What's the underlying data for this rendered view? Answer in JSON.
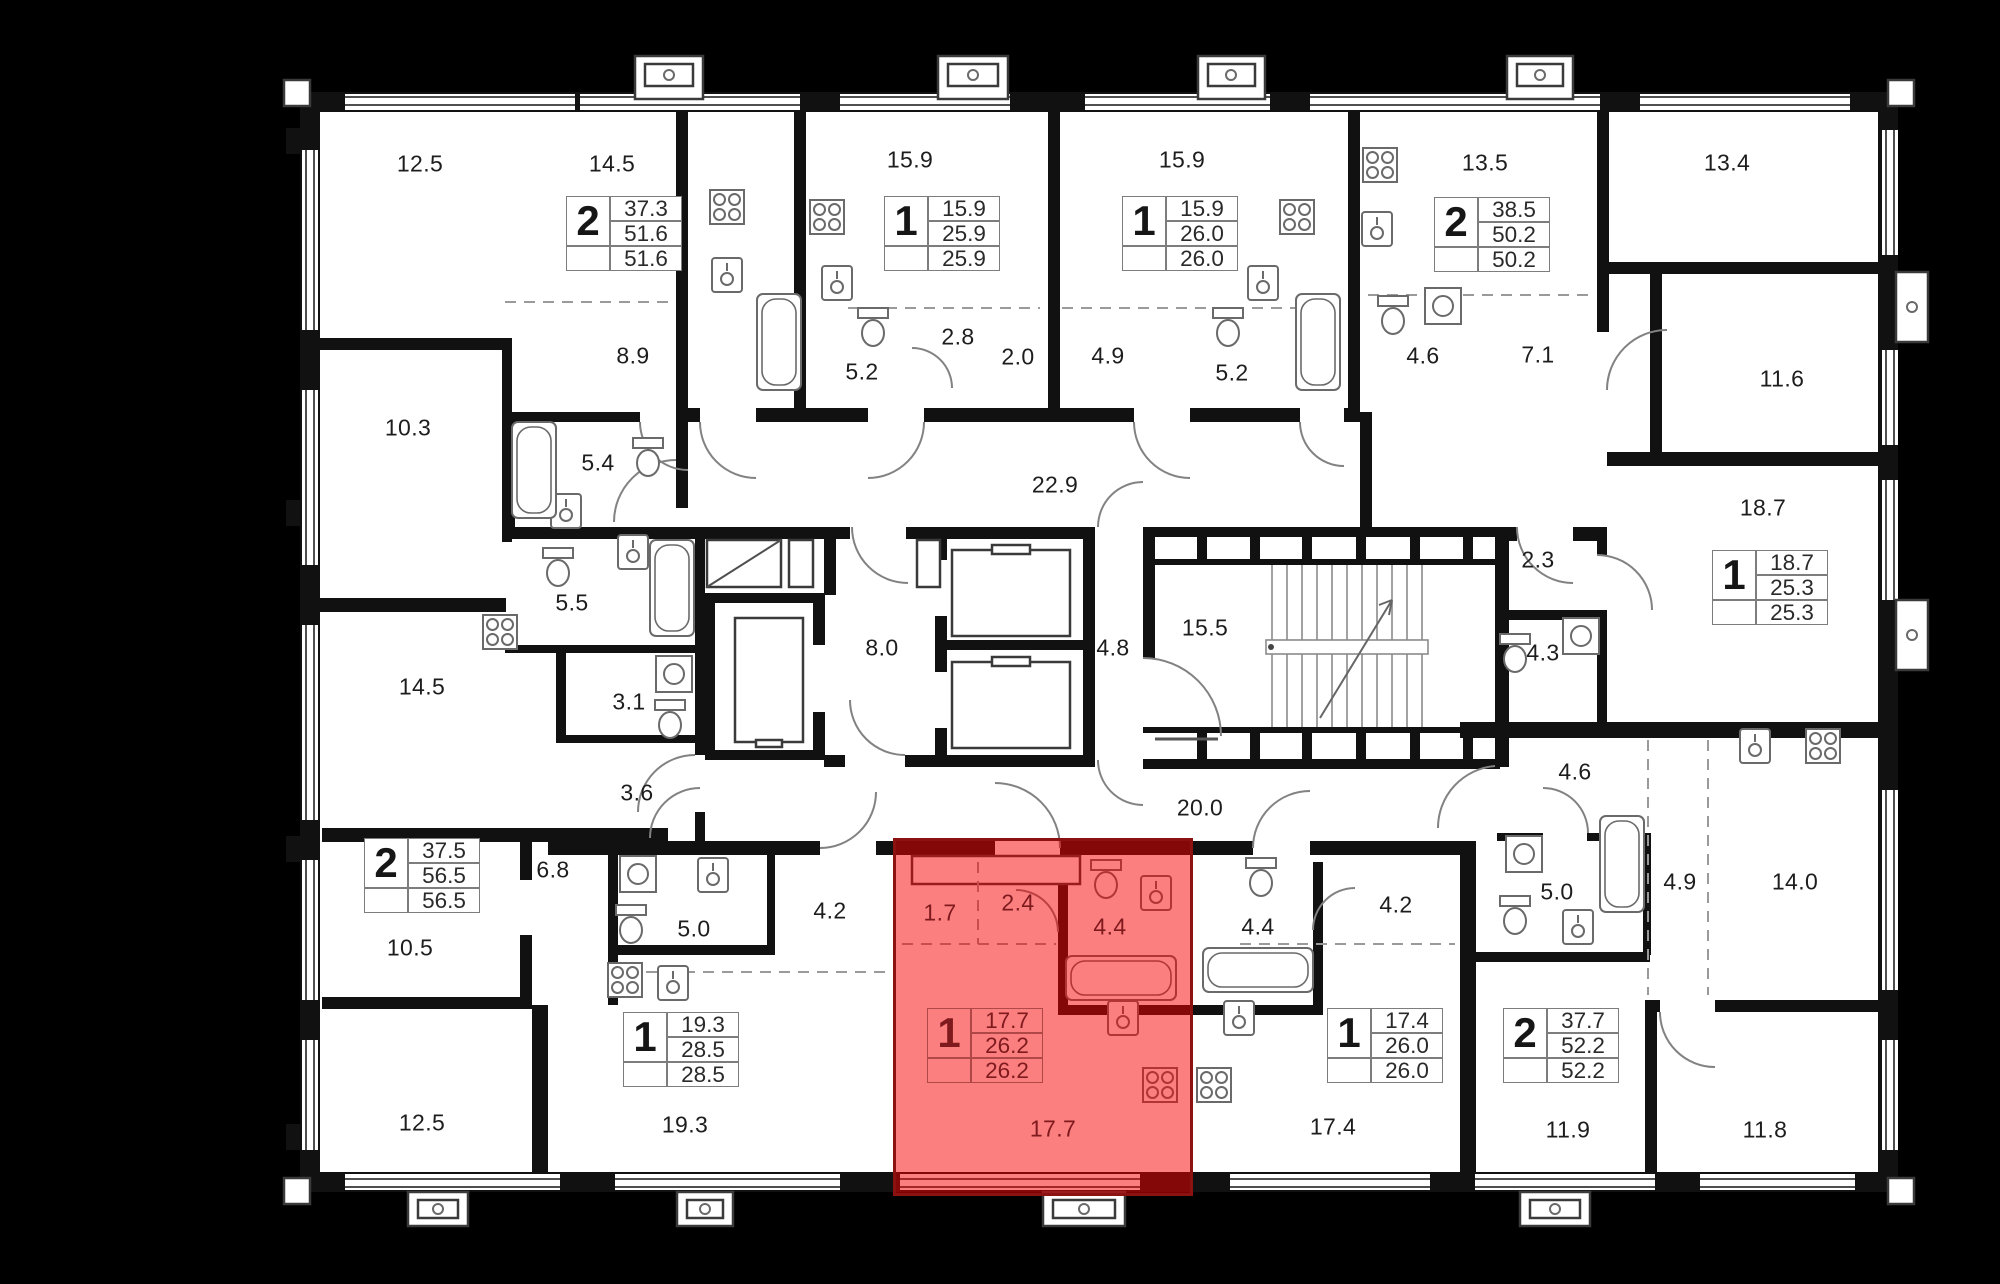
{
  "colors": {
    "background": "#000000",
    "floor": "#ffffff",
    "wall": "#111111",
    "fixture_line": "#6a6a6a",
    "dash_line": "#9a9a9a",
    "label_text": "#1d1d1d",
    "badge_line": "#7d7d7d",
    "highlight_fill": "rgba(249,0,0,0.5)",
    "highlight_border": "#8c1212",
    "highlight_text": "#7e1a1e"
  },
  "labels": [
    {
      "t": "12.5"
    },
    {
      "t": "14.5"
    },
    {
      "t": "15.9"
    },
    {
      "t": "15.9"
    },
    {
      "t": "13.5"
    },
    {
      "t": "13.4"
    },
    {
      "t": "10.3"
    },
    {
      "t": "8.9"
    },
    {
      "t": "5.4"
    },
    {
      "t": "5.2"
    },
    {
      "t": "2.8"
    },
    {
      "t": "2.0"
    },
    {
      "t": "4.9"
    },
    {
      "t": "5.2"
    },
    {
      "t": "4.6"
    },
    {
      "t": "7.1"
    },
    {
      "t": "11.6"
    },
    {
      "t": "22.9"
    },
    {
      "t": "18.7"
    },
    {
      "t": "2.3"
    },
    {
      "t": "5.5"
    },
    {
      "t": "8.0"
    },
    {
      "t": "4.8"
    },
    {
      "t": "15.5"
    },
    {
      "t": "4.3"
    },
    {
      "t": "14.5"
    },
    {
      "t": "3.1"
    },
    {
      "t": "3.6"
    },
    {
      "t": "20.0"
    },
    {
      "t": "4.6"
    },
    {
      "t": "6.8"
    },
    {
      "t": "10.5"
    },
    {
      "t": "5.0"
    },
    {
      "t": "4.2"
    },
    {
      "t": "1.7"
    },
    {
      "t": "2.4"
    },
    {
      "t": "4.4"
    },
    {
      "t": "4.4"
    },
    {
      "t": "4.2"
    },
    {
      "t": "5.0"
    },
    {
      "t": "4.9"
    },
    {
      "t": "14.0"
    },
    {
      "t": "12.5"
    },
    {
      "t": "19.3"
    },
    {
      "t": "17.7"
    },
    {
      "t": "17.4"
    },
    {
      "t": "11.9"
    },
    {
      "t": "11.8"
    }
  ],
  "apartments": [
    {
      "rooms": "2",
      "living": "37.3",
      "area2": "51.6",
      "total": "51.6"
    },
    {
      "rooms": "1",
      "living": "15.9",
      "area2": "25.9",
      "total": "25.9"
    },
    {
      "rooms": "1",
      "living": "15.9",
      "area2": "26.0",
      "total": "26.0"
    },
    {
      "rooms": "2",
      "living": "38.5",
      "area2": "50.2",
      "total": "50.2"
    },
    {
      "rooms": "1",
      "living": "18.7",
      "area2": "25.3",
      "total": "25.3"
    },
    {
      "rooms": "2",
      "living": "37.5",
      "area2": "56.5",
      "total": "56.5"
    },
    {
      "rooms": "1",
      "living": "19.3",
      "area2": "28.5",
      "total": "28.5"
    },
    {
      "rooms": "1",
      "living": "17.7",
      "area2": "26.2",
      "total": "26.2"
    },
    {
      "rooms": "1",
      "living": "17.4",
      "area2": "26.0",
      "total": "26.0"
    },
    {
      "rooms": "2",
      "living": "37.7",
      "area2": "52.2",
      "total": "52.2"
    }
  ]
}
